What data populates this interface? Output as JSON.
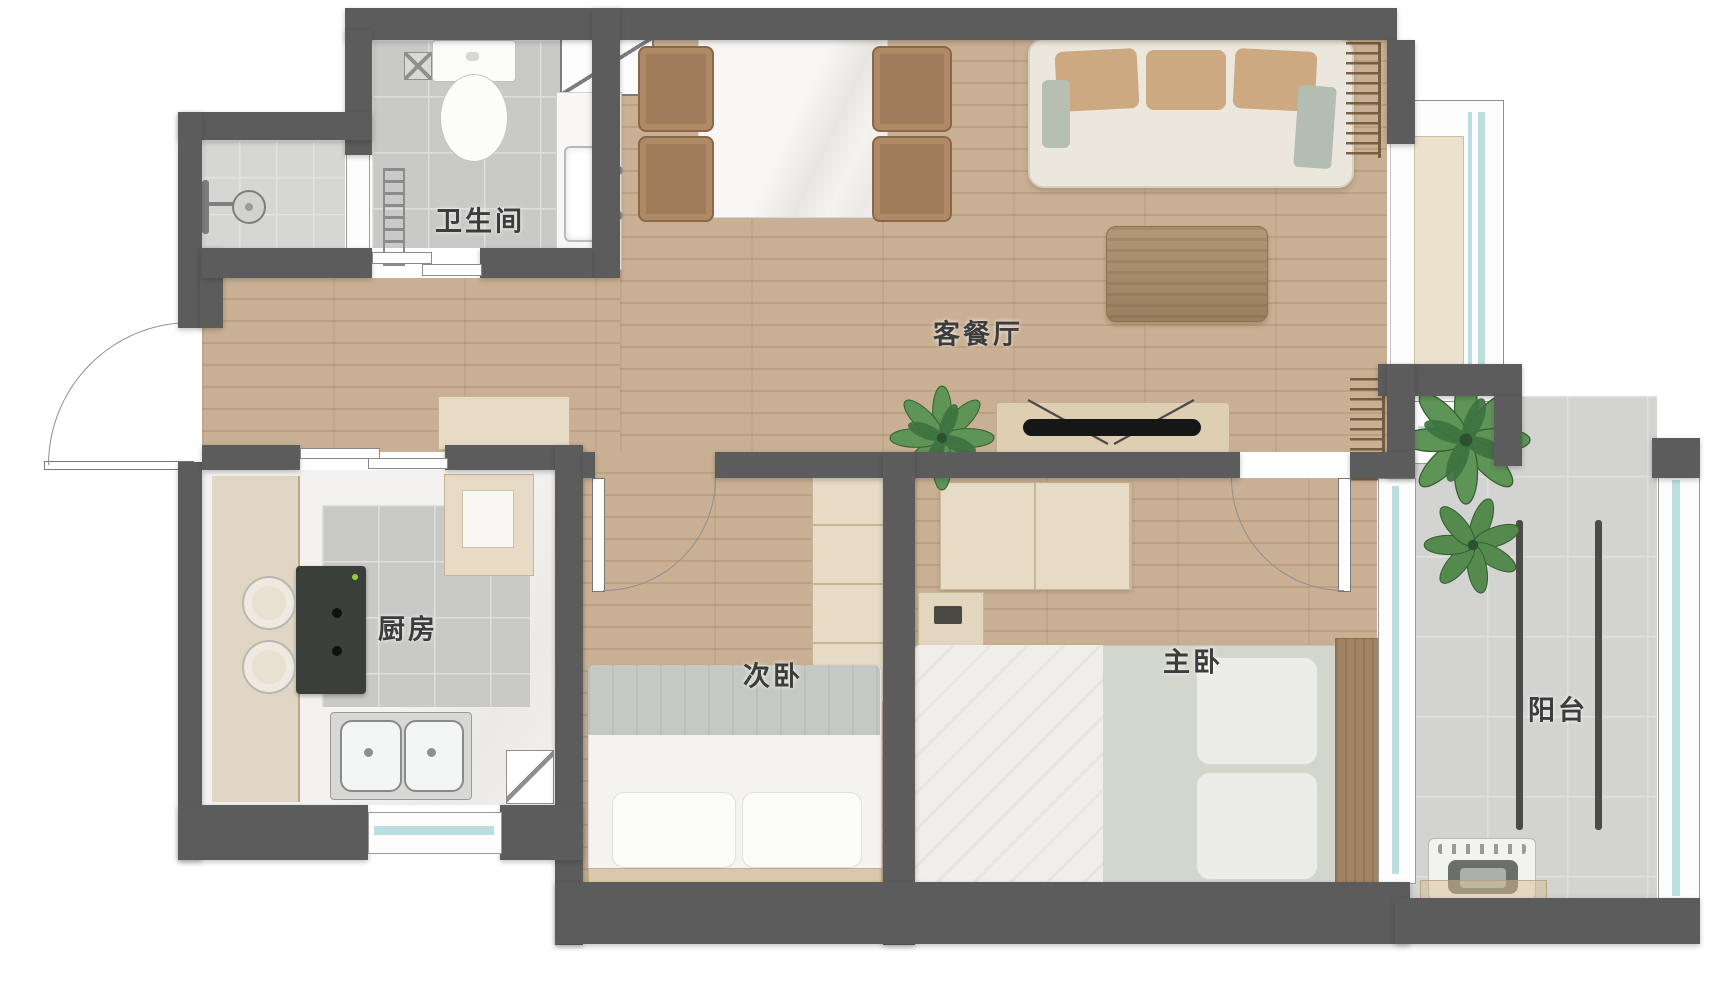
{
  "plan_type": "apartment-floor-plan",
  "rooms": {
    "bathroom": {
      "label": "卫生间"
    },
    "living_dining": {
      "label": "客餐厅"
    },
    "kitchen": {
      "label": "厨房"
    },
    "second_bedroom": {
      "label": "次卧"
    },
    "master_bedroom": {
      "label": "主卧"
    },
    "balcony": {
      "label": "阳台"
    }
  },
  "palette": {
    "wall": "#5c5c5c",
    "wood_floor": "#c9b094",
    "tile_floor": "#c9c9c7",
    "balcony_tile": "#d3d3d1",
    "counter_marble": "#f2f1ef",
    "bay_window_sill": "#ebe1cd",
    "window_glass": "#bcdede",
    "furniture_beige": "#e7dbc6",
    "sofa_cream": "#ece7dd",
    "cushion_tan": "#cda981",
    "wood_furniture": "#a98e6f",
    "plant_green": "#5f9457",
    "tv_black": "#161616",
    "label_text": "#3c3c3c"
  },
  "icons": [
    "toilet-icon",
    "floor-drain-icon",
    "shower-head-icon",
    "towel-rail-icon",
    "vanity-sink-icon",
    "casement-window-icon",
    "sliding-door-icon",
    "entry-door-icon",
    "interior-door-icon",
    "dining-table-icon",
    "dining-chair-icon",
    "sofa-icon",
    "coffee-table-icon",
    "tv-icon",
    "tv-console-icon",
    "radiator-icon",
    "plant-icon",
    "cooktop-icon",
    "kitchen-sink-icon",
    "corner-cabinet-icon",
    "tall-cabinet-icon",
    "wardrobe-icon",
    "bed-icon",
    "pillow-icon",
    "dresser-icon",
    "bench-icon",
    "washing-machine-icon",
    "drying-rail-icon",
    "bay-window-icon",
    "glass-wall-icon",
    "window-icon"
  ]
}
